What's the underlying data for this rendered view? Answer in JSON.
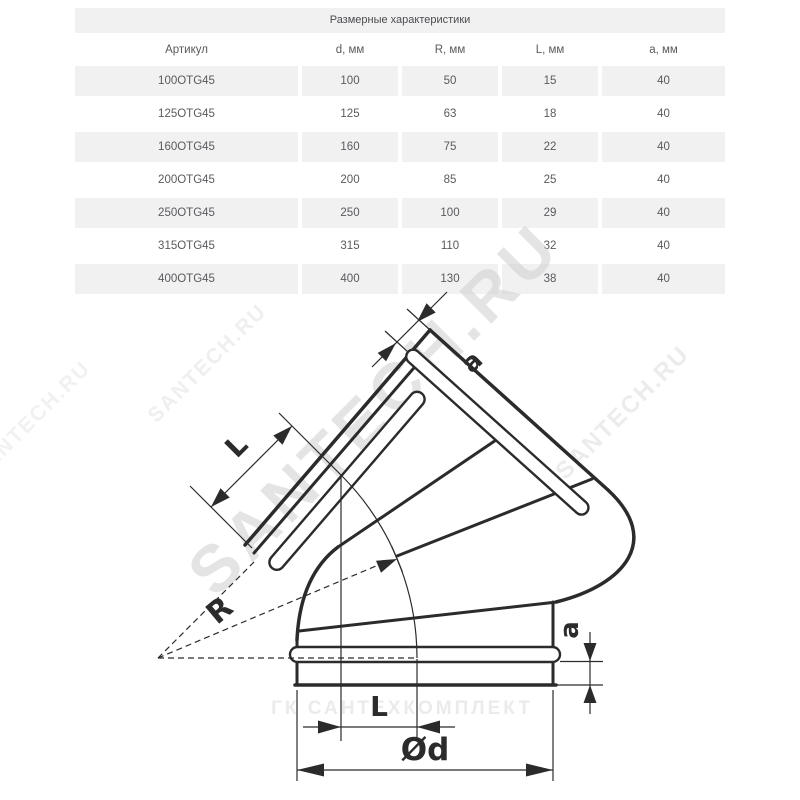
{
  "table": {
    "title": "Размерные характеристики",
    "columns": [
      "Артикул",
      "d, мм",
      "R, мм",
      "L, мм",
      "a, мм"
    ],
    "rows": [
      [
        "100OTG45",
        "100",
        "50",
        "15",
        "40"
      ],
      [
        "125OTG45",
        "125",
        "63",
        "18",
        "40"
      ],
      [
        "160OTG45",
        "160",
        "75",
        "22",
        "40"
      ],
      [
        "200OTG45",
        "200",
        "85",
        "25",
        "40"
      ],
      [
        "250OTG45",
        "250",
        "100",
        "29",
        "40"
      ],
      [
        "315OTG45",
        "315",
        "110",
        "32",
        "40"
      ],
      [
        "400OTG45",
        "400",
        "130",
        "38",
        "40"
      ]
    ]
  },
  "diagram": {
    "labels": {
      "radius": "R",
      "length_top": "L",
      "length_bottom": "L",
      "lip_top": "a",
      "lip_right": "a",
      "diameter": "Ød"
    }
  },
  "watermarks": {
    "main": "SANTECH.RU",
    "side_right": "SANTECH.RU",
    "side_topleft": "SANTECH.RU",
    "side_left": "SANTECH.RU",
    "brand_bottom": "ГК САНТЕХКОМПЛЕКТ"
  },
  "colors": {
    "stripe": "#f1f1f2",
    "table_text": "#5a5a5e",
    "line": "#2b2b2b",
    "watermark_big": "#cfcfcf",
    "watermark_faint": "#ececec"
  }
}
